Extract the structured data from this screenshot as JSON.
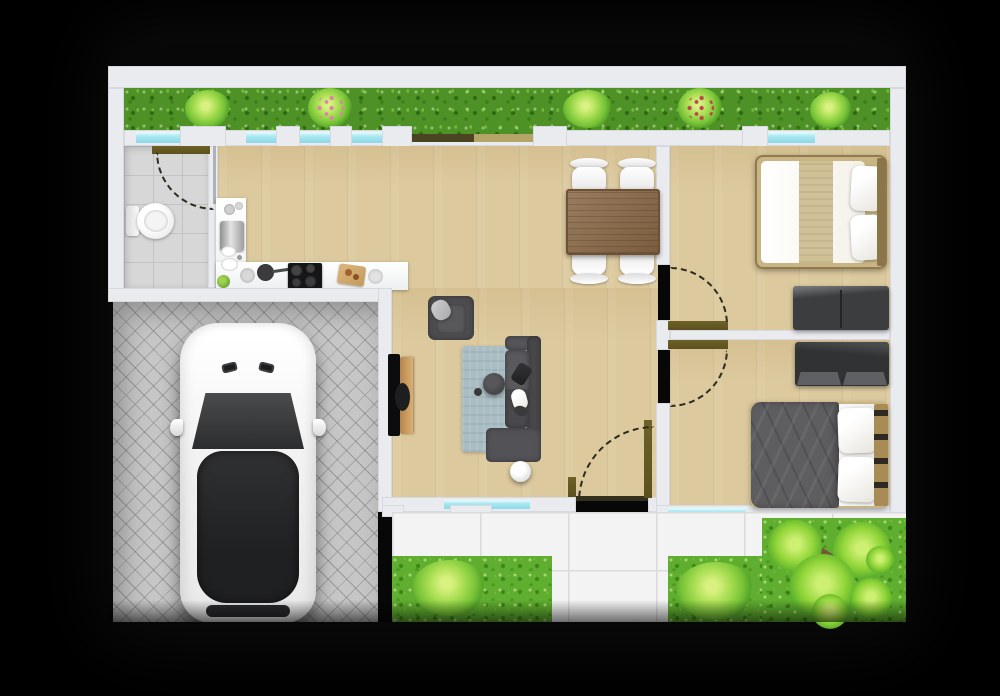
{
  "colors": {
    "background": "#000000",
    "wall": "#e9ebef",
    "window-glass": "#a9e8f2",
    "hedge-green": "#4e9126",
    "grass-green": "#5fae2f",
    "wood-floor": "#dcc99e",
    "bath-tile": "#d7d7d7",
    "patio-tile": "#f3f3f3",
    "paving": "#c6c6c6",
    "door-olive": "#5c511e",
    "dining-table-wood": "#8b6a48",
    "sofa-gray": "#4d4d50",
    "rug-blue": "#a9bdc3",
    "bed-frame-tan": "#c9b584",
    "bed-runner-khaki": "#cfc096",
    "duvet-gray": "#5e5d5f",
    "furniture-dark": "#3c3d3f",
    "car-white": "#fafafa",
    "car-glass": "#2c2d2f"
  },
  "floorplan": {
    "view": "top-down-3d-render",
    "rooms": [
      {
        "name": "bathroom",
        "furniture": [
          "toilet"
        ]
      },
      {
        "name": "kitchen",
        "furniture": [
          "fridge",
          "sink",
          "cooktop",
          "l-shaped-counter",
          "cutting-board",
          "pan",
          "plates",
          "plant"
        ]
      },
      {
        "name": "dining-area",
        "furniture": [
          "dining-table",
          "chair",
          "chair",
          "chair",
          "chair"
        ]
      },
      {
        "name": "living-room",
        "furniture": [
          "sofa",
          "armchair",
          "rug",
          "coffee-table",
          "tv",
          "media-console",
          "ball-lamp"
        ]
      },
      {
        "name": "bedroom-top",
        "furniture": [
          "double-bed",
          "pillows",
          "bench"
        ]
      },
      {
        "name": "bedroom-bottom",
        "furniture": [
          "double-bed",
          "pillows",
          "dresser"
        ]
      },
      {
        "name": "driveway",
        "furniture": [
          "car"
        ]
      },
      {
        "name": "patio",
        "furniture": []
      },
      {
        "name": "garden",
        "furniture": [
          "hedge",
          "bushes",
          "tree"
        ]
      }
    ],
    "swing_doors": 4,
    "sliding_doors": 1,
    "windows": 7
  }
}
